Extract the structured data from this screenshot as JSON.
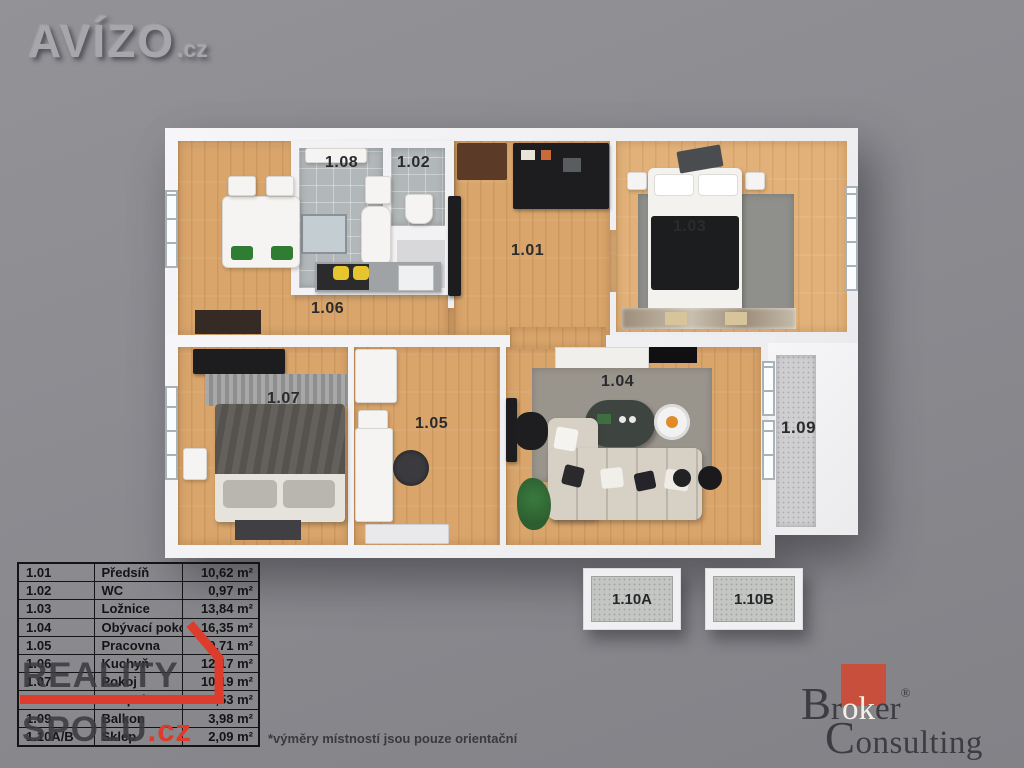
{
  "branding": {
    "avizo": {
      "name": "AVÍZO",
      "tld": ".cz"
    },
    "reality": {
      "line1": "REALITY",
      "line2": "SPOLU",
      "tld": ".cz"
    },
    "broker": {
      "b": "B",
      "r": "r",
      "ok": "ok",
      "er": "er",
      "reg": "®",
      "c": "C",
      "onsulting": "onsulting"
    }
  },
  "colors": {
    "background": "#8b8b90",
    "reality_red": "#dd3b2b",
    "broker_red": "#c84f3c",
    "wood_floor": "#d9a56b",
    "tile_floor": "#b2b7b9",
    "wall_white": "#f2f2f4"
  },
  "floorplan": {
    "rooms": [
      {
        "id": "1.01",
        "label": "1.01"
      },
      {
        "id": "1.02",
        "label": "1.02"
      },
      {
        "id": "1.03",
        "label": "1.03"
      },
      {
        "id": "1.04",
        "label": "1.04"
      },
      {
        "id": "1.05",
        "label": "1.05"
      },
      {
        "id": "1.06",
        "label": "1.06"
      },
      {
        "id": "1.07",
        "label": "1.07"
      },
      {
        "id": "1.08",
        "label": "1.08"
      },
      {
        "id": "1.09",
        "label": "1.09"
      }
    ],
    "storage": [
      {
        "label": "1.10A"
      },
      {
        "label": "1.10B"
      }
    ]
  },
  "legend": {
    "rows": [
      {
        "num": "1.01",
        "name": "Předsíň",
        "area": "10,62 m²"
      },
      {
        "num": "1.02",
        "name": "WC",
        "area": "0,97 m²"
      },
      {
        "num": "1.03",
        "name": "Ložnice",
        "area": "13,84 m²"
      },
      {
        "num": "1.04",
        "name": "Obývací pokoj",
        "area": "16,35 m²"
      },
      {
        "num": "1.05",
        "name": "Pracovna",
        "area": "9,71 m²"
      },
      {
        "num": "1.06",
        "name": "Kuchyň",
        "area": "12,17 m²"
      },
      {
        "num": "1.07",
        "name": "Pokoj",
        "area": "10,19 m²"
      },
      {
        "num": "1.08",
        "name": "Koupelna",
        "area": "2,53 m²"
      },
      {
        "num": "1.09",
        "name": "Balkon",
        "area": "3,98 m²"
      },
      {
        "num": "1.10A/B",
        "name": "Sklep",
        "area": "2,09 m²"
      }
    ]
  },
  "footnote": "*výměry místností jsou pouze orientační"
}
